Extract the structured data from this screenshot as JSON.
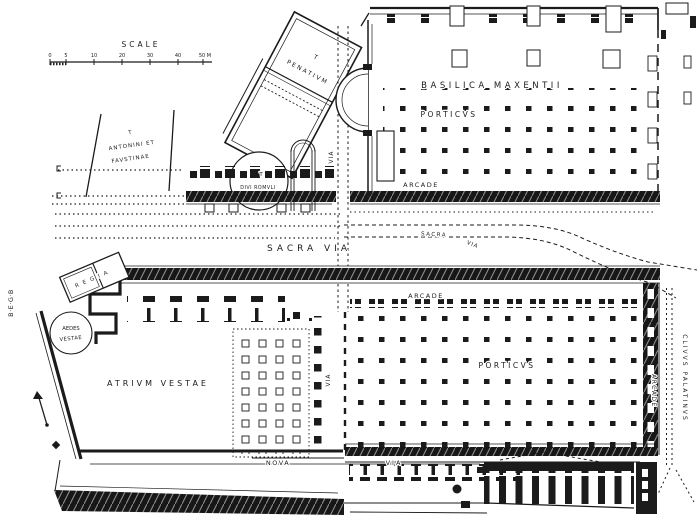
{
  "colors": {
    "ink": "#1b1b1b",
    "paper": "#ffffff"
  },
  "scalebar": {
    "title": "SCALE",
    "ticks": [
      "0",
      "5",
      "10",
      "20",
      "30",
      "40",
      "50 M"
    ]
  },
  "labels": {
    "basilica": "BASILICA MAXENTII",
    "porticus_upper": "PORTICVS",
    "arcade_upper": "ARCADE",
    "penatium_t": "T",
    "penatium": "PENATIVM",
    "antonini_t": "T",
    "antonini_1": "ANTONINI ET",
    "antonini_2": "FAVSTINAE",
    "romuli_t": "T",
    "romuli": "DIVI ROMVLI",
    "via_upper": "VIA",
    "sacra_via": "SACRA VIA",
    "sacra_small": "SACRA",
    "via_small": "VIA",
    "arcade_mid": "ARCADE",
    "porticus_lower": "PORTICVS",
    "arcade_right": "ARCADE",
    "clivus": "CLIVVS PALATINVS",
    "aedes_1": "AEDES",
    "aedes_2": "VESTAE",
    "regia": "REGIA",
    "atrium": "ATRIVM VESTAE",
    "via_lower": "VIA",
    "nova": "NOVA",
    "nova_via": "VIA"
  },
  "margin": {
    "glyphs": "B·E·G·B"
  }
}
